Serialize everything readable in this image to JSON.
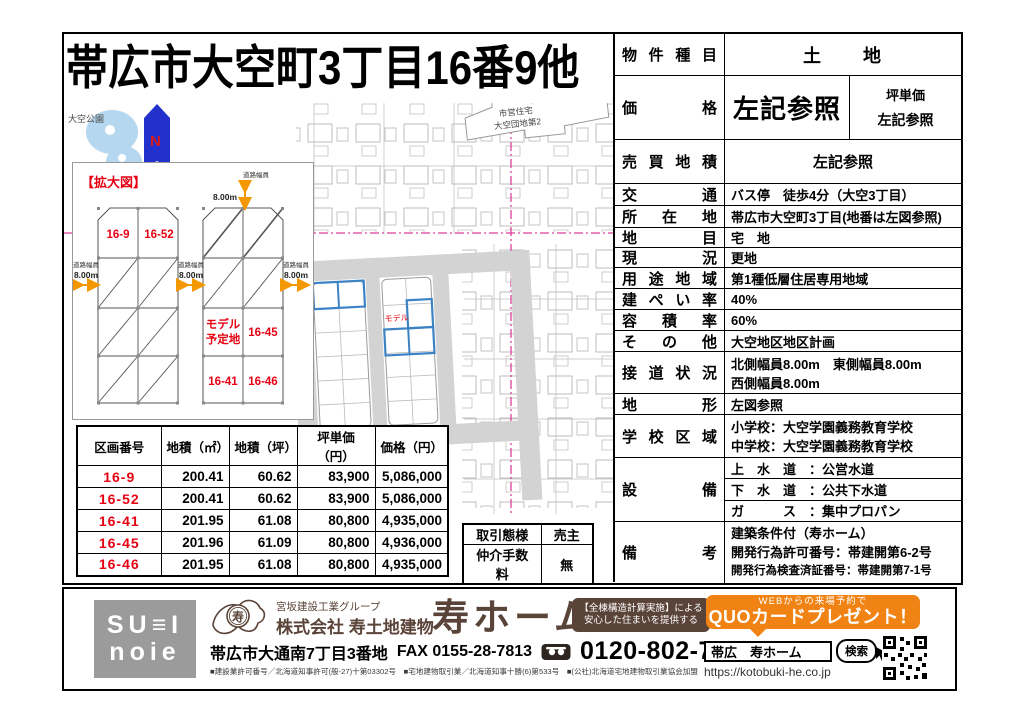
{
  "title": "帯広市大空町3丁目16番9他",
  "map": {
    "park": "大空公園",
    "north": "N",
    "housing1": "市営住宅",
    "housing2": "大空団地第2",
    "model": "モデル",
    "inset": {
      "heading": "【拡大図】",
      "road_label": "道路幅員",
      "road_value": "8.00m",
      "lot_16_9": "16-9",
      "lot_16_52": "16-52",
      "model1": "モデル",
      "model2": "予定地",
      "lot_16_45": "16-45",
      "lot_16_41": "16-41",
      "lot_16_46": "16-46"
    }
  },
  "price_table": {
    "headers": [
      "区画番号",
      "地積（㎡）",
      "地積（坪）",
      "坪単価（円）",
      "価格（円）"
    ],
    "rows": [
      {
        "lot": "16-9",
        "m2": "200.41",
        "tsubo": "60.62",
        "unit": "83,900",
        "price": "5,086,000"
      },
      {
        "lot": "16-52",
        "m2": "200.41",
        "tsubo": "60.62",
        "unit": "83,900",
        "price": "5,086,000"
      },
      {
        "lot": "16-41",
        "m2": "201.95",
        "tsubo": "61.08",
        "unit": "80,800",
        "price": "4,935,000"
      },
      {
        "lot": "16-45",
        "m2": "201.96",
        "tsubo": "61.09",
        "unit": "80,800",
        "price": "4,936,000"
      },
      {
        "lot": "16-46",
        "m2": "201.95",
        "tsubo": "61.08",
        "unit": "80,800",
        "price": "4,935,000"
      }
    ]
  },
  "deal": {
    "r1l": "取引態様",
    "r1v": "売主",
    "r2l": "仲介手数料",
    "r2v": "無"
  },
  "details": {
    "property_type": {
      "label": "物 件 種 目",
      "value": "土　　地"
    },
    "price": {
      "label": "価 格",
      "value": "左記参照",
      "sub_label": "坪単価",
      "sub_value": "左記参照"
    },
    "sale_area": {
      "label": "売 買 地 積",
      "value": "左記参照"
    },
    "transport": {
      "label": "交 通",
      "value": "バス停　徒歩4分（大空3丁目）"
    },
    "location": {
      "label": "所 在 地",
      "value": "帯広市大空町3丁目(地番は左図参照)"
    },
    "land_category": {
      "label": "地 目",
      "value": "宅　地"
    },
    "current_state": {
      "label": "現 況",
      "value": "更地"
    },
    "zoning": {
      "label": "用 途 地 域",
      "value": "第1種低層住居専用地域"
    },
    "building_coverage": {
      "label": "建 ぺ い 率",
      "value": "40%"
    },
    "floor_area_ratio": {
      "label": "容 積 率",
      "value": "60%"
    },
    "other": {
      "label": "そ の 他",
      "value": "大空地区地区計画"
    },
    "road_access": {
      "label": "接 道 状 況",
      "line1": "北側幅員8.00m　東側幅員8.00m",
      "line2": "西側幅員8.00m"
    },
    "land_shape": {
      "label": "地 形",
      "value": "左図参照"
    },
    "school_district": {
      "label": "学 校 区 域",
      "line1": "小学校：大空学園義務教育学校",
      "line2": "中学校：大空学園義務教育学校"
    },
    "utilities": {
      "label": "設 備",
      "water": "上　水　道　：公営水道",
      "sewer": "下　水　道　：公共下水道",
      "gas": "ガ　　　ス　：集中プロパン"
    },
    "remarks": {
      "label": "備 考",
      "line1": "建築条件付（寿ホーム）",
      "line2": "開発行為許可番号：帯建開第6-2号",
      "line3": "開発行為検査済証番号：帯建開第7-1号"
    }
  },
  "footer": {
    "logo_line1": "SU≡I",
    "logo_line2": "noie",
    "group": "宮坂建設工業グループ",
    "company": "株式会社 寿土地建物",
    "brand": "寿ホーム",
    "mark": "寿",
    "badge_line1": "【全棟構造計算実施】による",
    "badge_line2": "安心した住まいを提供する",
    "address": "帯広市大通南7丁目3番地",
    "fax": "FAX 0155-28-7813",
    "phone": "0120-802-766",
    "licenses": "■建設業許可番号／北海道知事許可(般-27)十第03302号　■宅地建物取引業／北海道知事十勝(6)第533号　■(公社)北海道宅地建物取引業協会加盟",
    "bubble_line1": "WEBからの来場予約で",
    "bubble_line2": "QUOカードプレゼント！",
    "search_text": "帯広　寿ホーム",
    "search_button": "検索",
    "url": "https://kotobuki-he.co.jp"
  },
  "colors": {
    "red": "#e60012",
    "orange": "#f39800",
    "brown": "#5a4338",
    "north_blue": "#2231cc",
    "lot_blue": "#3d82c4",
    "pink": "#e03f9b",
    "bubble_orange": "#f08314"
  }
}
